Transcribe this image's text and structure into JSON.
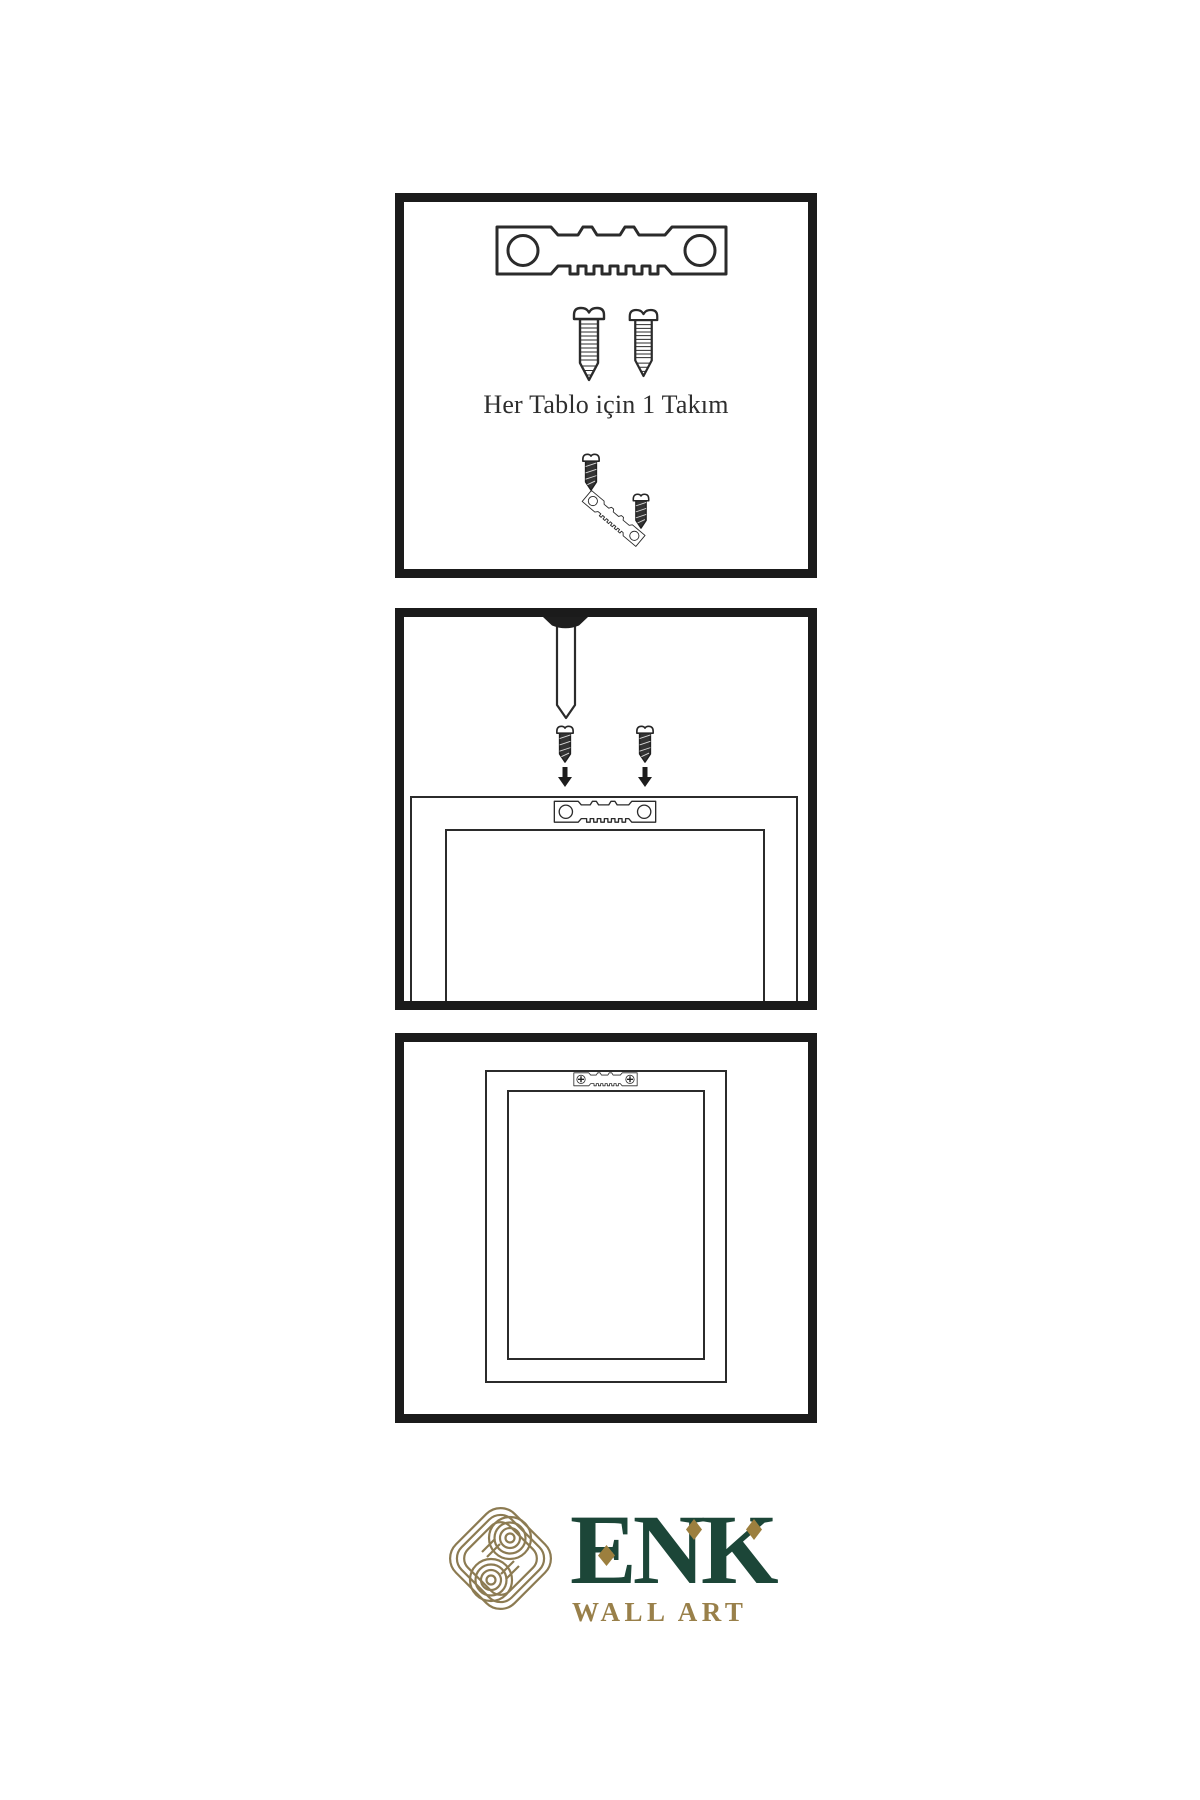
{
  "instructions": {
    "step1": {
      "caption": "Her Tablo için 1 Takım",
      "items": [
        "sawtooth-hanger",
        "mounting-screw",
        "mounting-screw",
        "screw-into-hanger-demo"
      ]
    },
    "step2": {
      "items": [
        "wall-nail",
        "mounting-screw",
        "mounting-screw",
        "down-arrow",
        "down-arrow",
        "sawtooth-hanger-on-frame-back",
        "frame-back-outline"
      ]
    },
    "step3": {
      "items": [
        "mounted-sawtooth-hanger",
        "hanging-frame-outline"
      ]
    }
  },
  "logo": {
    "brand": "ENK",
    "subtitle": "WALL ART",
    "mark": "interlaced-knot-icon"
  },
  "colors": {
    "background": "#ffffff",
    "panel_border": "#1b1b1b",
    "line_art": "#2b2b2b",
    "dark_screw_fill": "#333333",
    "brand_green": "#1c4638",
    "brand_gold": "#99804a",
    "knot_gold": "#8c7b52",
    "diamond_gold": "#9c7f3e"
  }
}
